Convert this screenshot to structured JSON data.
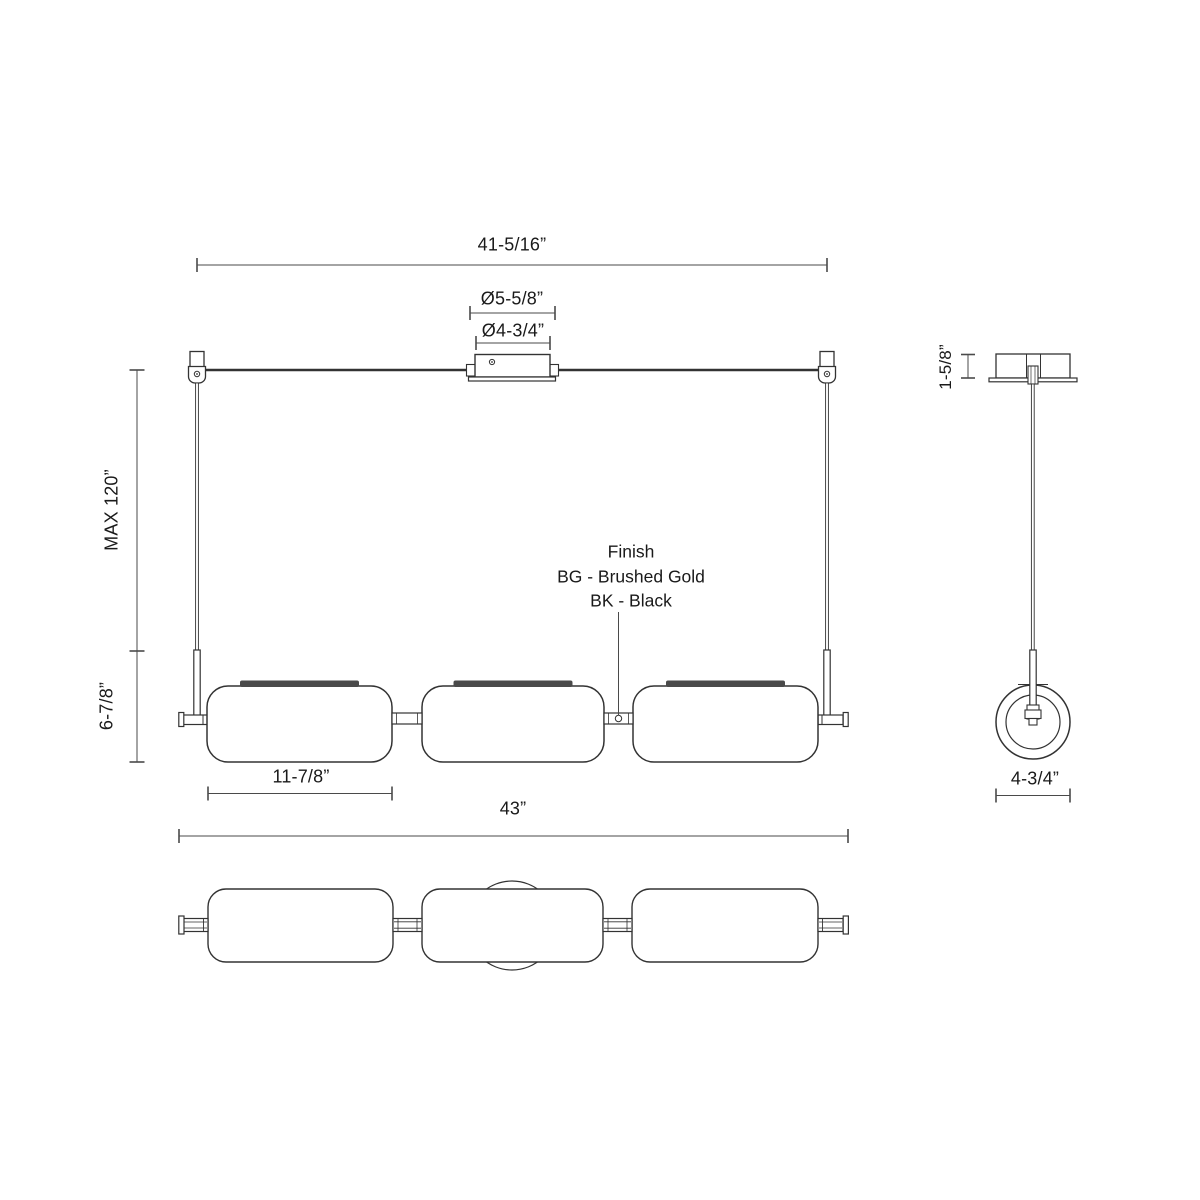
{
  "views": {
    "front": {
      "dims": {
        "suspension_width": "41-5/16”",
        "canopy_outer_dia": "Ø5-5/8”",
        "canopy_inner_dia": "Ø4-3/4”",
        "max_drop": "MAX 120”",
        "fixture_height": "6-7/8”",
        "shade_width": "11-7/8”",
        "overall_width": "43”"
      }
    },
    "side": {
      "dims": {
        "canopy_height": "1-5/8”",
        "fixture_diameter": "4-3/4”"
      }
    }
  },
  "finish": {
    "heading": "Finish",
    "option_bg": "BG - Brushed Gold",
    "option_bk": "BK - Black"
  },
  "colors": {
    "line": "#333333",
    "dim_line": "#4a4a4a",
    "text": "#1a1a1a",
    "shade_cap": "#4a4a4a"
  }
}
